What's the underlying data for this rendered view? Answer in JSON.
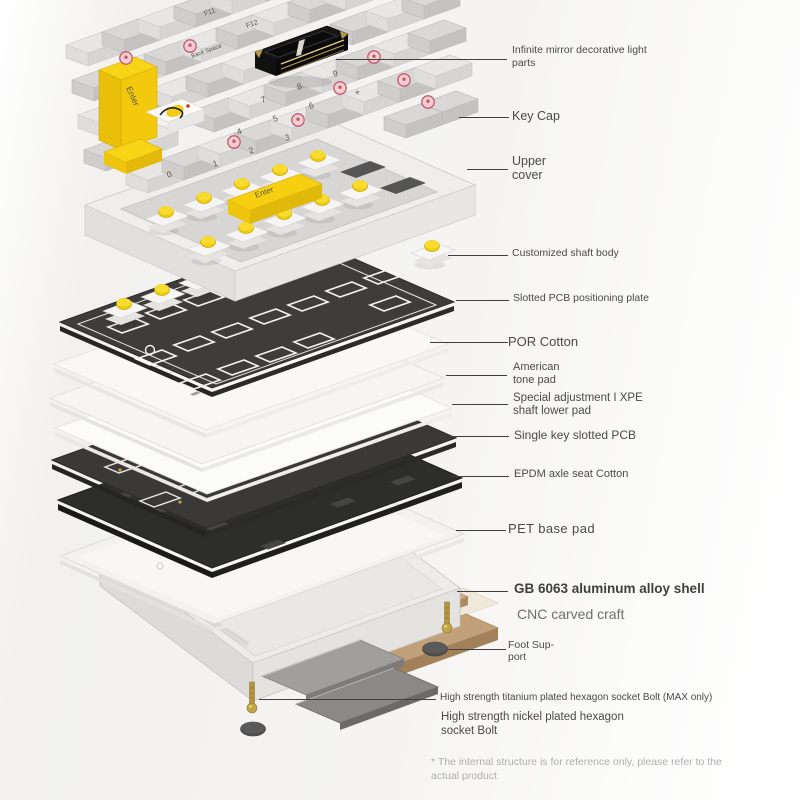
{
  "illustration": {
    "subject": "mechanical keyboard exploded internal structure diagram"
  },
  "callouts": [
    {
      "id": "infinite-mirror",
      "text": "Infinite mirror decorative light parts"
    },
    {
      "id": "key-cap",
      "text": "Key Cap"
    },
    {
      "id": "upper-cover",
      "text": "Upper cover"
    },
    {
      "id": "customized-shaft-body",
      "text": "Customized shaft body"
    },
    {
      "id": "slotted-pcb-positioning-plate",
      "text": "Slotted PCB positioning plate"
    },
    {
      "id": "por-cotton",
      "text": "POR Cotton"
    },
    {
      "id": "american-tone-pad",
      "text": "American tone pad"
    },
    {
      "id": "xpe-shaft-lower-pad",
      "text": "Special adjustment I XPE shaft lower pad"
    },
    {
      "id": "single-key-slotted-pcb",
      "text": "Single key slotted PCB"
    },
    {
      "id": "epdm-axle-seat-cotton",
      "text": "EPDM axle seat Cotton"
    },
    {
      "id": "pet-base-pad",
      "text": "PET base pad"
    },
    {
      "id": "gb6063-shell",
      "text": "GB 6063 aluminum alloy shell"
    },
    {
      "id": "cnc-craft",
      "text": "CNC carved craft"
    },
    {
      "id": "foot-support",
      "text": "Foot Sup-port"
    },
    {
      "id": "titanium-bolt",
      "text": "High strength titanium plated hexagon socket Bolt (MAX only)"
    },
    {
      "id": "nickel-bolt",
      "text": "High strength nickel plated hexagon socket Bolt"
    }
  ],
  "disclaimer": "* The internal structure is for reference only, please refer to the actual product",
  "keyboard": {
    "legends": {
      "f11": "F11",
      "f12": "F12",
      "backspace": "Back Space",
      "enter_left": "Enter",
      "enter_numpad": "Enter",
      "d7": "7",
      "d8": "8",
      "d9": "9",
      "d4": "4",
      "d5": "5",
      "d6": "6",
      "d1": "1",
      "d2": "2",
      "d3": "3",
      "d0": "0",
      "plus": "+",
      "minus": "-"
    }
  },
  "colors": {
    "accent_yellow": "#f5d013",
    "badge_pink": "#c2596b",
    "plate_dark": "#3e3d3c",
    "epdm_black": "#2d2d2c",
    "pcb_dark": "#3a3938",
    "gold_weight": "#c2a17a",
    "shell_gray": "#edecea",
    "label_text": "#4a4a4a",
    "disclaimer_gray": "#aeaeae",
    "background": "#f4f3f2"
  }
}
